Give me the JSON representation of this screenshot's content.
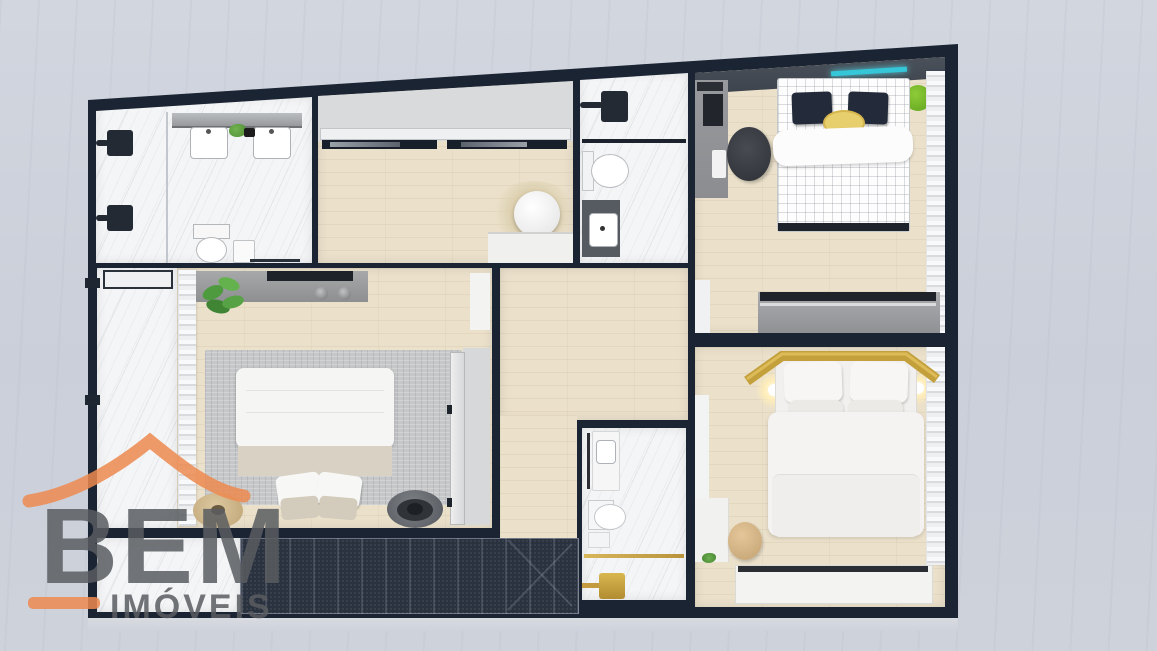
{
  "watermark": {
    "brand": "BEM",
    "sub": "IMÓVEIS"
  },
  "palette": {
    "wall": "#1b2433",
    "background_concrete": "#ced2db",
    "wood_floor": "#ebe1cb",
    "marble_floor": "#f4f5f6",
    "stairs_dark": "#2a323f",
    "rug_gray": "#c5c7c9",
    "logo_orange": "#ee8a50",
    "logo_gray": "#5a5d61",
    "gold_fixture": "#c4a03c",
    "led_teal": "#35c6d8",
    "plant_green": "#5fae3f",
    "pouf_lime": "#7fc12c",
    "pillow_navy": "#232b3a",
    "basket_yellow": "#e8cf6e",
    "stool_wood": "#d4b488"
  }
}
